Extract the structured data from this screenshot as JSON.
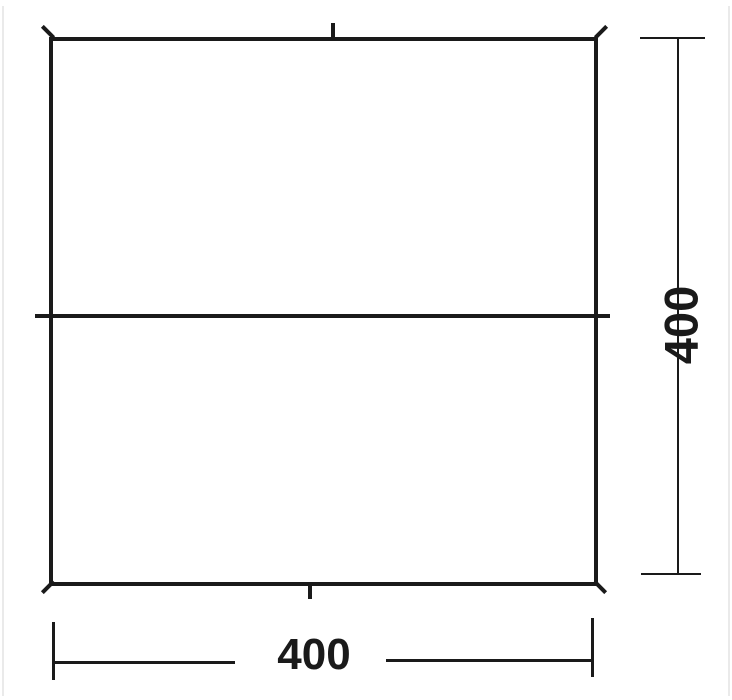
{
  "diagram": {
    "type": "dimension-drawing",
    "shape": "square-tarp-outline",
    "colors": {
      "line": "#1a1a1a",
      "background": "#ffffff",
      "edge_artifact": "#eaeaea"
    },
    "dimensions": {
      "width": {
        "label": "400"
      },
      "height": {
        "label": "400"
      }
    }
  }
}
